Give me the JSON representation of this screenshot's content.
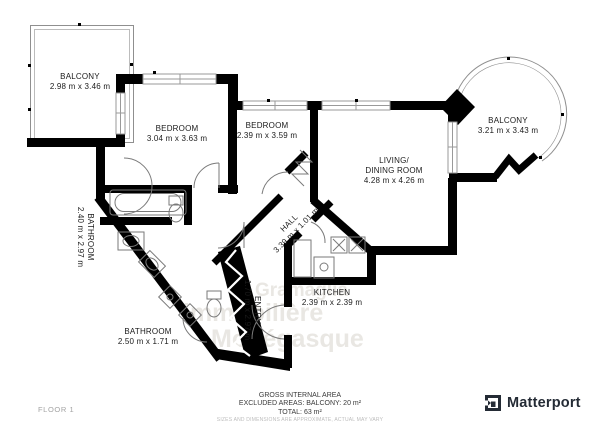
{
  "plan": {
    "rooms": {
      "balcony_left": {
        "name": "BALCONY",
        "dims": "2.98 m x 3.46 m"
      },
      "bedroom_1": {
        "name": "BEDROOM",
        "dims": "3.04 m x 3.63 m"
      },
      "bedroom_2": {
        "name": "BEDROOM",
        "dims": "2.39 m x 3.59 m"
      },
      "living_dining": {
        "name_line1": "LIVING/",
        "name_line2": "DINING ROOM",
        "dims": "4.28 m x 4.26 m"
      },
      "balcony_right": {
        "name": "BALCONY",
        "dims": "3.21 m x 3.43 m"
      },
      "bathroom_left": {
        "name": "BATHROOM",
        "dims": "2.40 m x 2.97 m"
      },
      "bathroom_bottom": {
        "name": "BATHROOM",
        "dims": "2.50 m x 1.71 m"
      },
      "hall": {
        "name": "HALL",
        "dims": "3.39 m x 1.01 m"
      },
      "entry": {
        "name": "ENTRY",
        "dims": "1.70 m x 2.97 m"
      },
      "kitchen": {
        "name": "KITCHEN",
        "dims": "2.39 m x 2.39 m"
      }
    },
    "watermark": {
      "line1": "Gramaglia",
      "line2": "immobilière",
      "line3": "Monégasque"
    }
  },
  "footer": {
    "area_title": "GROSS INTERNAL AREA",
    "area_excluded": "EXCLUDED AREAS: BALCONY: 20 m²",
    "area_total": "TOTAL: 63 m²",
    "disclaimer": "SIZES AND DIMENSIONS ARE APPROXIMATE, ACTUAL MAY VARY",
    "floor_label": "FLOOR 1",
    "brand": "Matterport"
  },
  "colors": {
    "wall": "#000000",
    "thin_line": "#8f8f8f",
    "fixture_line": "#7a7a7a",
    "label_text": "#1b1b1b",
    "footer_text": "#3a3a3a",
    "muted_text": "#a3a3a3",
    "watermark": "#e9e7e3",
    "brand": "#242b35"
  }
}
